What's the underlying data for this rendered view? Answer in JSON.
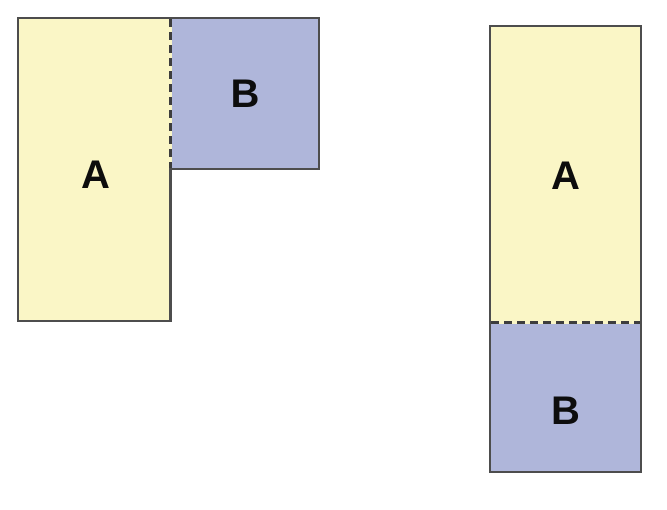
{
  "colors": {
    "background": "#ffffff",
    "region_a_fill": "#FAF6C6",
    "region_b_fill": "#AFB6DA",
    "border": "#4d4d4d",
    "dashed_line": "#3d3d3d",
    "label_text": "#0d0d0d"
  },
  "figure_left": {
    "description": "L-shaped arrangement: rectangle A with square B attached at top-right, shared edge dashed",
    "region_a": {
      "label": "A"
    },
    "region_b": {
      "label": "B"
    }
  },
  "figure_right": {
    "description": "Stacked arrangement: rectangle A on top of rectangle B, shared edge dashed",
    "region_a": {
      "label": "A"
    },
    "region_b": {
      "label": "B"
    }
  }
}
